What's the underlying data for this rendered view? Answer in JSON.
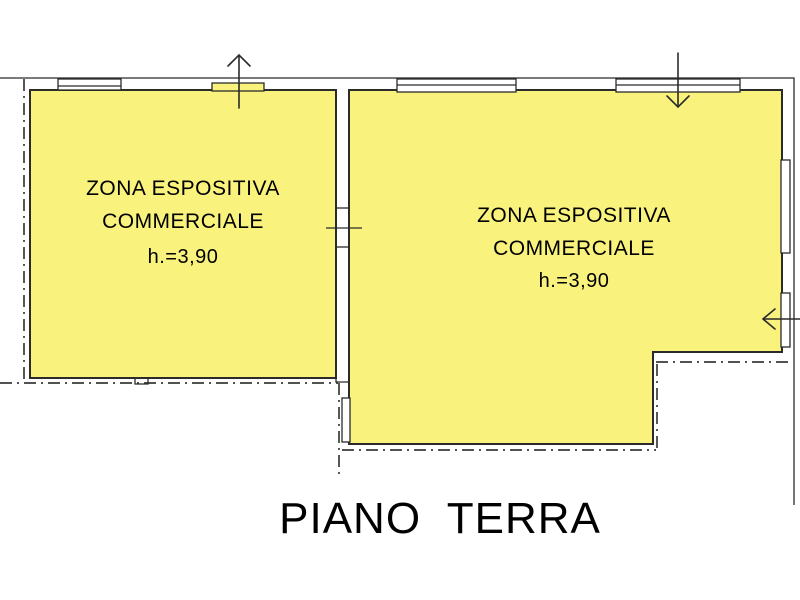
{
  "plan": {
    "title": "PIANO  TERRA",
    "room_left": {
      "line1": "ZONA ESPOSITIVA",
      "line2": "COMMERCIALE",
      "height": "h.=3,90"
    },
    "room_right": {
      "line1": "ZONA ESPOSITIVA",
      "line2": "COMMERCIALE",
      "height": "h.=3,90"
    },
    "colors": {
      "room_fill": "#F9F37D",
      "line_color": "#2B2B2B",
      "boundary_dash_color": "#3A3A3A"
    },
    "icons": {
      "north_arrow": "arrow-up",
      "top_entry_arrow": "arrow-down",
      "side_entry_arrow": "arrow-left"
    }
  }
}
